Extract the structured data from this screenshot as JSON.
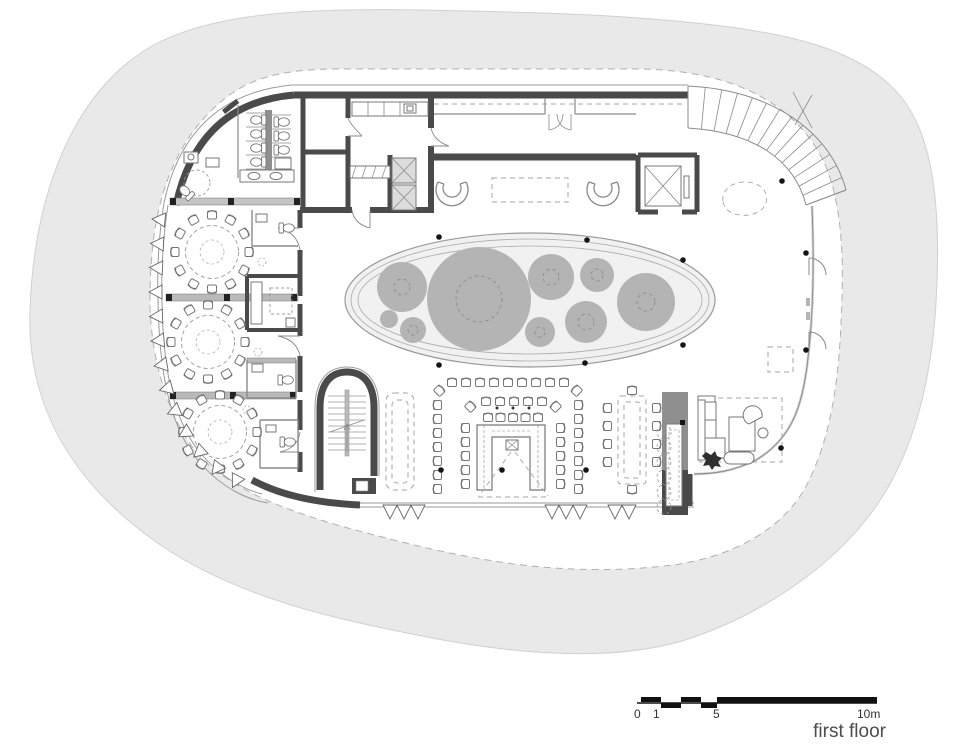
{
  "title": {
    "label": "first floor"
  },
  "scale_bar": {
    "tick_0": "0",
    "tick_1": "1",
    "tick_5": "5",
    "tick_10": "10m"
  },
  "colors": {
    "site": "#e9e9e9",
    "site_edge": "#cfcfcf",
    "wall_dark": "#4a4a4a",
    "wall_medium": "#8f8f8f",
    "band_gray": "#bdbdbd",
    "planter_fill": "#f1f1f1",
    "tree": "#b4b4b4",
    "trunk_dash": "#8d8d8d",
    "column_dot": "#151515",
    "text": "#4d4d4d"
  }
}
